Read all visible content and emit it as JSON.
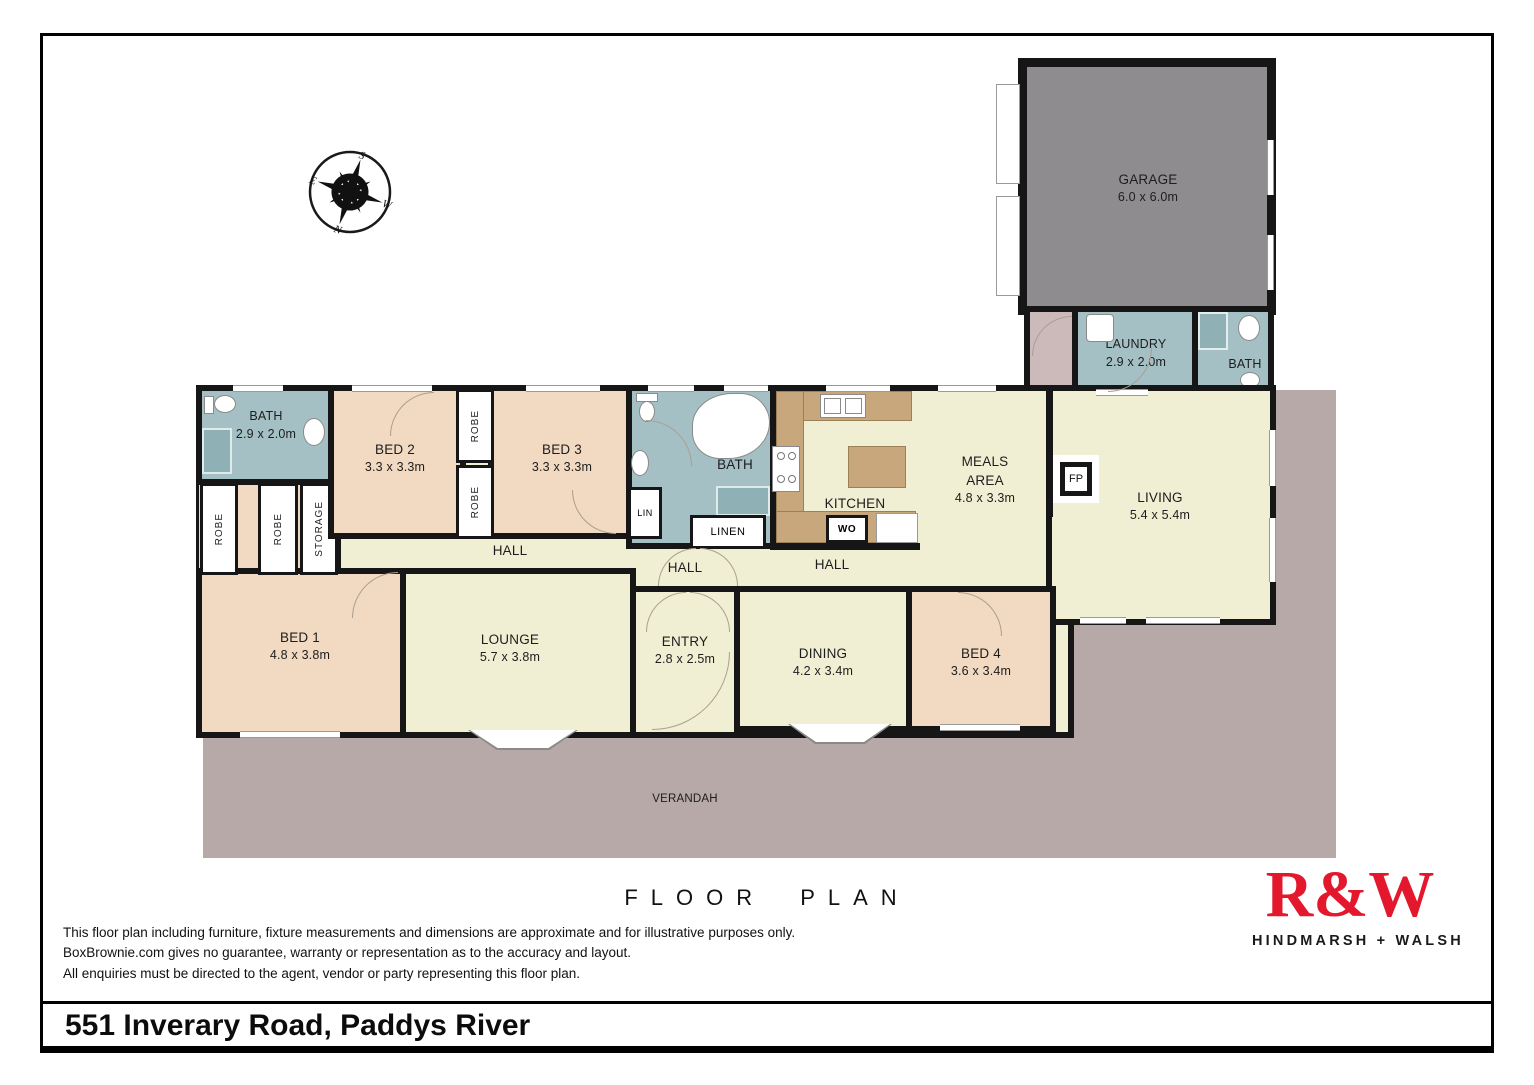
{
  "page": {
    "floor_plan_title": "FLOOR PLAN",
    "address": "551 Inverary Road, Paddys River"
  },
  "compass": {
    "north": "N",
    "south": "S",
    "east": "E",
    "west": "W"
  },
  "branding": {
    "logo": "R&W",
    "tagline": "HINDMARSH + WALSH",
    "brand_red": "#e4182d"
  },
  "disclaimer": {
    "line1": "This floor plan including furniture, fixture measurements and dimensions are approximate and for illustrative purposes only.",
    "line2": "BoxBrownie.com gives no guarantee, warranty or representation as to the accuracy and layout.",
    "line3": "All enquiries must be directed to the agent, vendor or party representing this floor plan."
  },
  "rooms": {
    "garage": {
      "name": "GARAGE",
      "dims": "6.0 x 6.0m"
    },
    "laundry": {
      "name": "LAUNDRY",
      "dims": "2.9 x 2.0m"
    },
    "bath_rear": {
      "name": "BATH"
    },
    "bath_main": {
      "name": "BATH",
      "dims": "2.9 x 2.0m"
    },
    "bed2": {
      "name": "BED 2",
      "dims": "3.3 x 3.3m"
    },
    "bed3": {
      "name": "BED 3",
      "dims": "3.3 x 3.3m"
    },
    "bath_ensuite": {
      "name": "BATH"
    },
    "kitchen": {
      "name": "KITCHEN"
    },
    "meals": {
      "name": "MEALS AREA",
      "dims": "4.8 x 3.3m"
    },
    "living": {
      "name": "LIVING",
      "dims": "5.4 x 5.4m"
    },
    "bed1": {
      "name": "BED 1",
      "dims": "4.8 x 3.8m"
    },
    "lounge": {
      "name": "LOUNGE",
      "dims": "5.7 x 3.8m"
    },
    "entry": {
      "name": "ENTRY",
      "dims": "2.8 x 2.5m"
    },
    "dining": {
      "name": "DINING",
      "dims": "4.2 x 3.4m"
    },
    "bed4": {
      "name": "BED 4",
      "dims": "3.6 x 3.4m"
    },
    "verandah": {
      "name": "VERANDAH"
    }
  },
  "labels": {
    "hall": "HALL",
    "robe": "ROBE",
    "storage": "STORAGE",
    "lin": "LIN",
    "linen": "LINEN",
    "wall_oven": "WO",
    "fireplace": "FP"
  },
  "colors": {
    "bedroom": "#f2d9c1",
    "living_areas": "#f1efd3",
    "wet_areas": "#a5c0c4",
    "garage": "#8f8c8f",
    "verandah": "#b6a9a8",
    "walls": "#161616"
  }
}
